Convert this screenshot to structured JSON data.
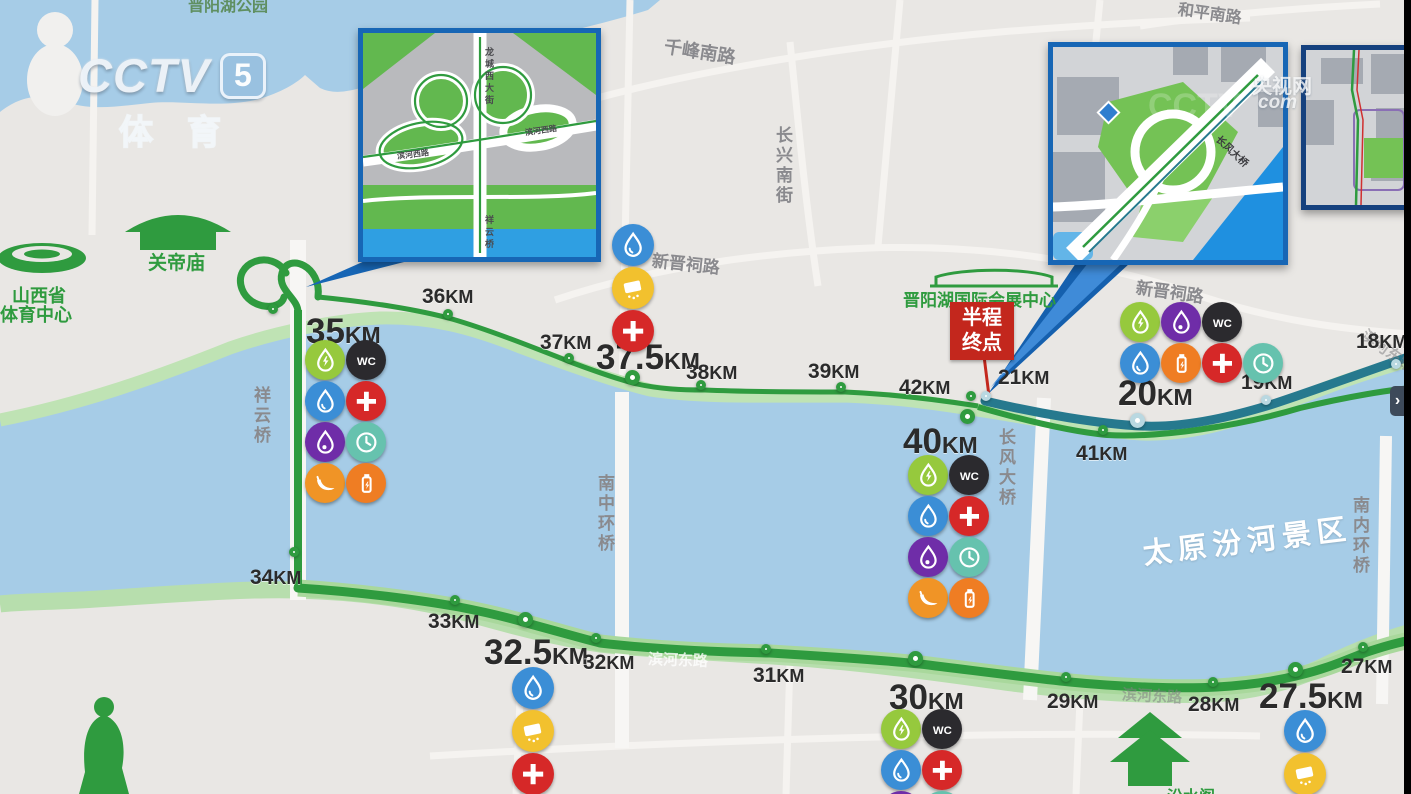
{
  "branding": {
    "logo_main": "CCTV",
    "logo_channel": "5",
    "logo_sub": "体育",
    "watermark_site": "央视网",
    "watermark_domain": "com"
  },
  "labels": {
    "lake_park": "晋阳湖公园",
    "guandi_temple": "关帝庙",
    "sports_center_l1": "山西省",
    "sports_center_l2": "体育中心",
    "convention_center": "晋阳湖国际会展中心",
    "fenshui_pavilion": "汾水阁",
    "scenic_area": "太原汾河景区",
    "qianfeng_south_rd": "千峰南路",
    "changxing_south_st": "长兴南街",
    "heping_south_rd": "和平南路",
    "xinjinci_rd_west": "新晋祠路",
    "xinjinci_rd_east": "新晋祠路",
    "binhe_east_rd_1": "滨河东路",
    "binhe_east_rd_2": "滨河东路",
    "binhe_east_rd_3": "滨河东路",
    "xiangyun_bridge": "祥云桥",
    "nanzhonghuan_bridge": "南中环桥",
    "changfeng_bridge": "长风大桥",
    "nanneihuan_bridge": "南内环桥"
  },
  "finish_badge": {
    "line1": "半程",
    "line2": "终点"
  },
  "insets": {
    "left": {
      "road_main": "龙城西大街",
      "road_side_a": "滨河西路",
      "road_side_b": "滨河西路",
      "bridge": "祥云桥"
    },
    "right": {
      "bridge": "长风大桥"
    }
  },
  "ui": {
    "pan_arrow": "›"
  },
  "colors": {
    "route_full": "#2f9b3f",
    "route_half": "#26798e",
    "water": "#a6cce7",
    "bank": "#b9dfae",
    "land": "#e9e7e4",
    "inset_border": "#1766b5",
    "finish_red": "#c3271d"
  },
  "icon_styles": {
    "water": {
      "bg": "#3b8ed6"
    },
    "drink": {
      "bg": "#96c93d"
    },
    "spray": {
      "bg": "#6f2da8"
    },
    "sponge": {
      "bg": "#f2c12e"
    },
    "medical": {
      "bg": "#d62828"
    },
    "toilet": {
      "bg": "#2b2a2e"
    },
    "clock": {
      "bg": "#66c2ae"
    },
    "banana": {
      "bg": "#f09426"
    },
    "gel": {
      "bg": "#ef7d23"
    }
  },
  "km_markers": [
    {
      "id": "35",
      "value": "35",
      "unit": "KM",
      "size": "large",
      "route": "full",
      "tx": 306,
      "ty": 312,
      "cx": 277,
      "cy": 313,
      "dot": "small"
    },
    {
      "id": "36",
      "value": "36",
      "unit": "KM",
      "size": "small",
      "route": "full",
      "tx": 422,
      "ty": 285,
      "cx": 452,
      "cy": 318,
      "dot": "small"
    },
    {
      "id": "37",
      "value": "37",
      "unit": "KM",
      "size": "small",
      "route": "full",
      "tx": 540,
      "ty": 331,
      "cx": 573,
      "cy": 362,
      "dot": "small"
    },
    {
      "id": "37.5",
      "value": "37.5",
      "unit": "KM",
      "size": "large",
      "route": "full",
      "tx": 596,
      "ty": 338,
      "cx": 637,
      "cy": 382,
      "dot": "large"
    },
    {
      "id": "38",
      "value": "38",
      "unit": "KM",
      "size": "small",
      "route": "full",
      "tx": 686,
      "ty": 361,
      "cx": 705,
      "cy": 389,
      "dot": "small"
    },
    {
      "id": "39",
      "value": "39",
      "unit": "KM",
      "size": "small",
      "route": "full",
      "tx": 808,
      "ty": 360,
      "cx": 845,
      "cy": 391,
      "dot": "small"
    },
    {
      "id": "40",
      "value": "40",
      "unit": "KM",
      "size": "large",
      "route": "full",
      "tx": 903,
      "ty": 422,
      "cx": 972,
      "cy": 421,
      "dot": "large"
    },
    {
      "id": "41",
      "value": "41",
      "unit": "KM",
      "size": "small",
      "route": "full",
      "tx": 1076,
      "ty": 442,
      "cx": 1107,
      "cy": 434,
      "dot": "small"
    },
    {
      "id": "42",
      "value": "42",
      "unit": "KM",
      "size": "small",
      "route": "full",
      "tx": 899,
      "ty": 376,
      "cx": 975,
      "cy": 400,
      "dot": "small"
    },
    {
      "id": "21",
      "value": "21",
      "unit": "KM",
      "size": "small",
      "route": "half",
      "tx": 998,
      "ty": 366,
      "cx": 990,
      "cy": 400,
      "dot": "small"
    },
    {
      "id": "20",
      "value": "20",
      "unit": "KM",
      "size": "large",
      "route": "half",
      "tx": 1118,
      "ty": 374,
      "cx": 1142,
      "cy": 425,
      "dot": "large"
    },
    {
      "id": "19",
      "value": "19",
      "unit": "KM",
      "size": "small",
      "route": "half",
      "tx": 1241,
      "ty": 371,
      "cx": 1270,
      "cy": 404,
      "dot": "small"
    },
    {
      "id": "18",
      "value": "18",
      "unit": "KM",
      "size": "small",
      "route": "half",
      "tx": 1356,
      "ty": 330,
      "cx": 1400,
      "cy": 368,
      "dot": "small"
    },
    {
      "id": "34",
      "value": "34",
      "unit": "KM",
      "size": "small",
      "route": "full",
      "tx": 250,
      "ty": 566,
      "cx": 298,
      "cy": 556,
      "dot": "small"
    },
    {
      "id": "33",
      "value": "33",
      "unit": "KM",
      "size": "small",
      "route": "full",
      "tx": 428,
      "ty": 610,
      "cx": 459,
      "cy": 604,
      "dot": "small"
    },
    {
      "id": "32.5",
      "value": "32.5",
      "unit": "KM",
      "size": "large",
      "route": "full",
      "tx": 484,
      "ty": 633,
      "cx": 530,
      "cy": 624,
      "dot": "large"
    },
    {
      "id": "32",
      "value": "32",
      "unit": "KM",
      "size": "small",
      "route": "full",
      "tx": 583,
      "ty": 651,
      "cx": 600,
      "cy": 642,
      "dot": "small"
    },
    {
      "id": "31",
      "value": "31",
      "unit": "KM",
      "size": "small",
      "route": "full",
      "tx": 753,
      "ty": 664,
      "cx": 770,
      "cy": 653,
      "dot": "small"
    },
    {
      "id": "30",
      "value": "30",
      "unit": "KM",
      "size": "large",
      "route": "full",
      "tx": 889,
      "ty": 678,
      "cx": 920,
      "cy": 663,
      "dot": "large"
    },
    {
      "id": "29",
      "value": "29",
      "unit": "KM",
      "size": "small",
      "route": "full",
      "tx": 1047,
      "ty": 690,
      "cx": 1070,
      "cy": 681,
      "dot": "small"
    },
    {
      "id": "28",
      "value": "28",
      "unit": "KM",
      "size": "small",
      "route": "full",
      "tx": 1188,
      "ty": 693,
      "cx": 1217,
      "cy": 686,
      "dot": "small"
    },
    {
      "id": "27.5",
      "value": "27.5",
      "unit": "KM",
      "size": "large",
      "route": "full",
      "tx": 1259,
      "ty": 677,
      "cx": 1300,
      "cy": 674,
      "dot": "large"
    },
    {
      "id": "27",
      "value": "27",
      "unit": "KM",
      "size": "small",
      "route": "full",
      "tx": 1341,
      "ty": 655,
      "cx": 1367,
      "cy": 651,
      "dot": "small"
    }
  ],
  "aid_stations": [
    {
      "at": "35KM",
      "x": 305,
      "y": 340,
      "icon_px": 40,
      "rows": [
        [
          "drink",
          "toilet"
        ],
        [
          "water",
          "medical"
        ],
        [
          "spray",
          "clock"
        ],
        [
          "banana",
          "gel"
        ]
      ]
    },
    {
      "at": "37.5KM",
      "x": 612,
      "y": 224,
      "icon_px": 42,
      "rows": [
        [
          "water"
        ],
        [
          "sponge"
        ],
        [
          "medical"
        ]
      ]
    },
    {
      "at": "40KM",
      "x": 908,
      "y": 455,
      "icon_px": 40,
      "rows": [
        [
          "drink",
          "toilet"
        ],
        [
          "water",
          "medical"
        ],
        [
          "spray",
          "clock"
        ],
        [
          "banana",
          "gel"
        ]
      ]
    },
    {
      "at": "20KM",
      "x": 1120,
      "y": 302,
      "icon_px": 40,
      "rows": [
        [
          "drink",
          "spray",
          "toilet"
        ],
        [
          "water",
          "gel",
          "medical",
          "clock"
        ]
      ]
    },
    {
      "at": "32.5KM",
      "x": 512,
      "y": 667,
      "icon_px": 42,
      "rows": [
        [
          "water"
        ],
        [
          "sponge"
        ],
        [
          "medical"
        ]
      ]
    },
    {
      "at": "30KM",
      "x": 881,
      "y": 709,
      "icon_px": 40,
      "rows": [
        [
          "drink",
          "toilet"
        ],
        [
          "water",
          "medical"
        ],
        [
          "spray",
          "clock"
        ]
      ]
    },
    {
      "at": "27.5KM",
      "x": 1284,
      "y": 710,
      "icon_px": 42,
      "rows": [
        [
          "water"
        ],
        [
          "sponge"
        ]
      ]
    }
  ]
}
